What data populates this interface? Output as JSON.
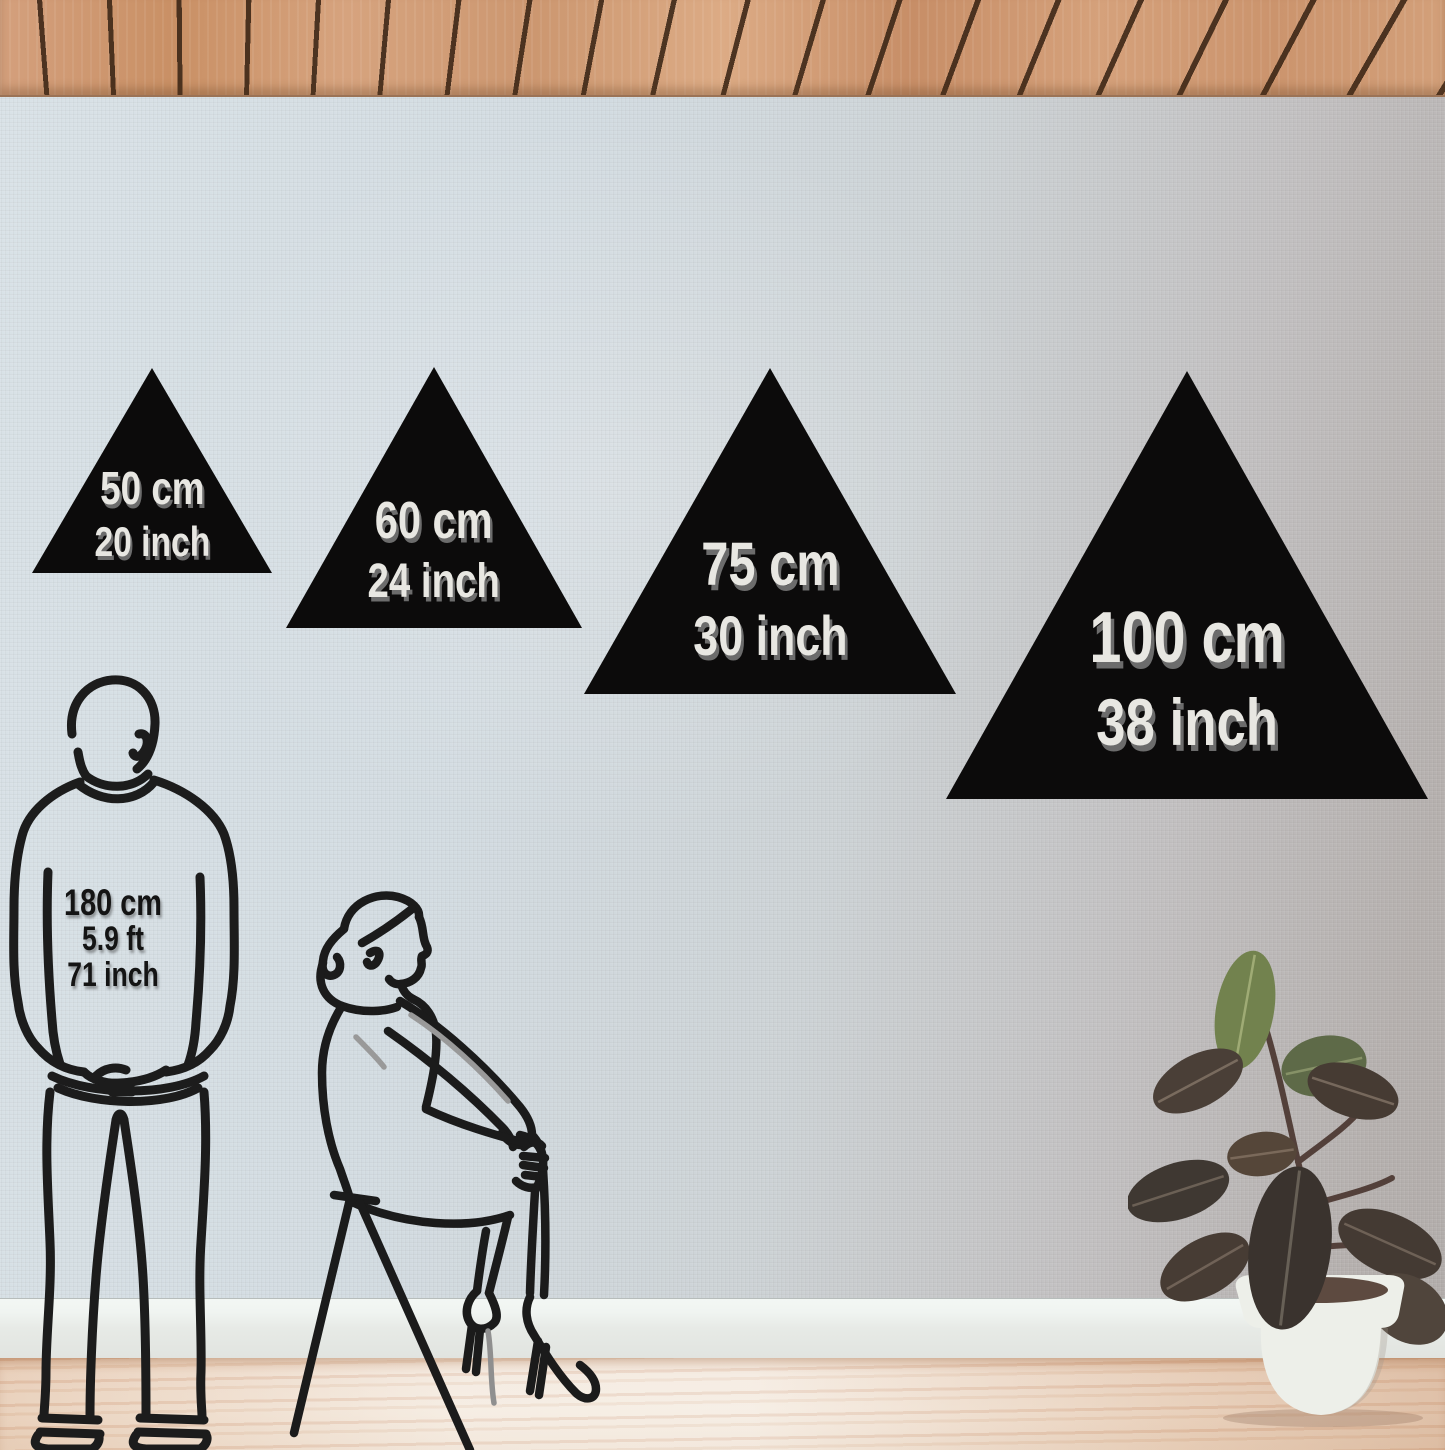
{
  "scene": {
    "type": "wall-decor size comparison mockup",
    "product": "black triangle wall panels",
    "room": {
      "ceiling": "wood slat ceiling",
      "wall": "linen textured wall",
      "floor": "light wood floor"
    }
  },
  "sizes": [
    {
      "cm": "50 cm",
      "inch": "20 inch"
    },
    {
      "cm": "60 cm",
      "inch": "24 inch"
    },
    {
      "cm": "75 cm",
      "inch": "30 inch"
    },
    {
      "cm": "100 cm",
      "inch": "38 inch"
    }
  ],
  "reference_person": {
    "cm": "180 cm",
    "ft": "5.9 ft",
    "inch": "71 inch"
  },
  "colors": {
    "triangle_fill": "#0c0b0b",
    "triangle_label_text": "#e8e7e2",
    "triangle_label_shadow": "#6c6c6c",
    "person_label_text": "#141414",
    "figure_line": "#1c1c1c",
    "figure_accent_gray": "#999999",
    "ceiling_wood": "#cf9772",
    "ceiling_slat_gap": "#342011",
    "wall_left": "#d9e2e7",
    "wall_right": "#b2adab",
    "baseboard": "#eceeeb",
    "floor_light": "#f0e3d4",
    "floor_warm": "#d9b493",
    "plant_pot": "#edefe9",
    "plant_soil": "#5d4a40",
    "leaf_green": "#72824e",
    "leaf_dark": "#443a33"
  }
}
